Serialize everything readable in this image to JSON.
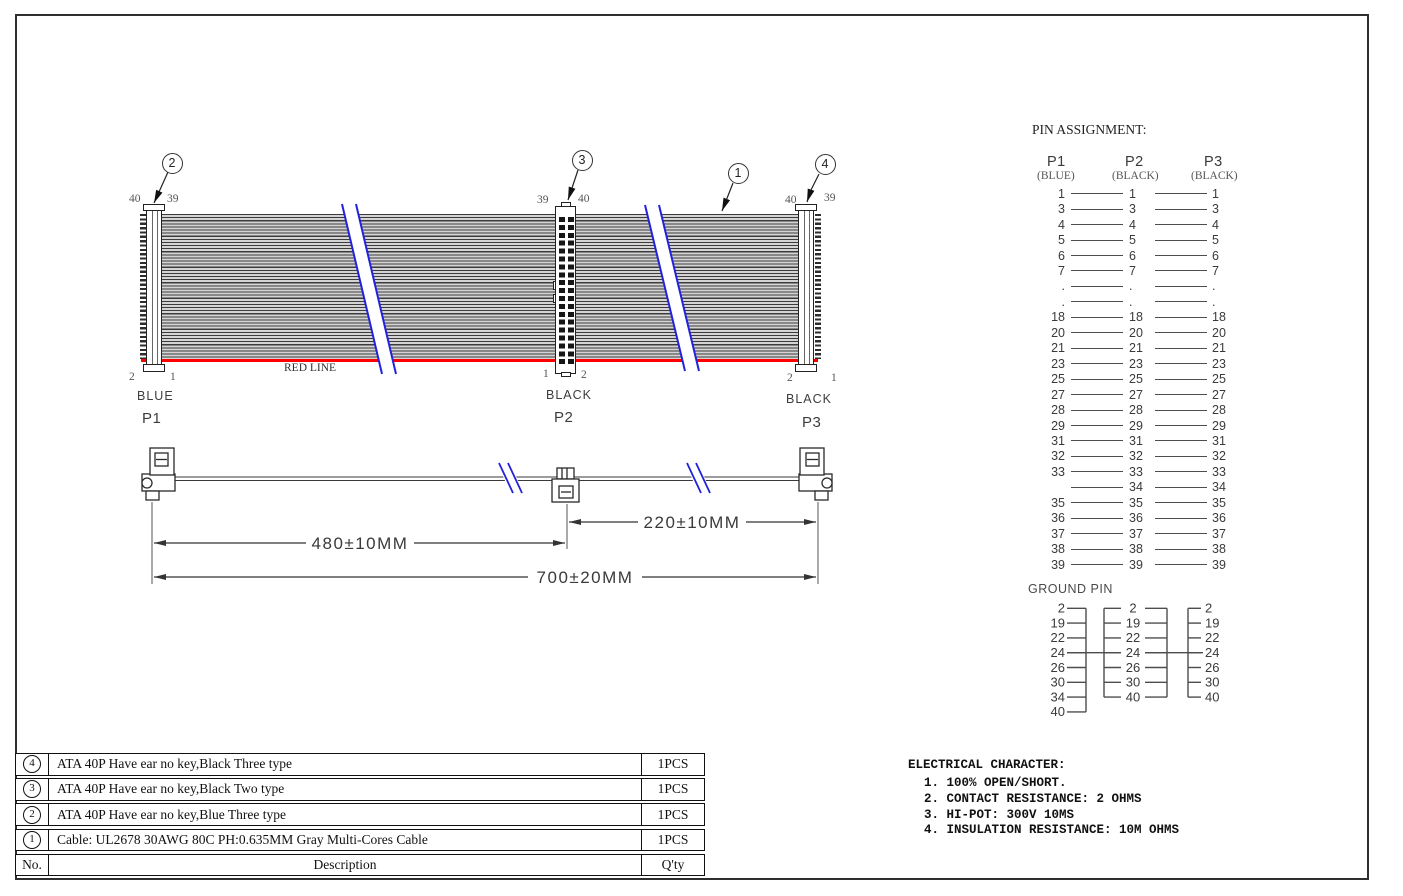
{
  "drawing": {
    "red_line_label": "RED LINE",
    "balloons": {
      "b1": "1",
      "b2": "2",
      "b3": "3",
      "b4": "4"
    },
    "connectors": [
      {
        "name": "P1",
        "color_label": "BLUE",
        "pins": {
          "tl": "40",
          "tr": "39",
          "bl": "2",
          "br": "1"
        }
      },
      {
        "name": "P2",
        "color_label": "BLACK",
        "pins": {
          "tl": "39",
          "tr": "40",
          "bl": "1",
          "br": "2"
        }
      },
      {
        "name": "P3",
        "color_label": "BLACK",
        "pins": {
          "tl": "40",
          "tr": "39",
          "bl": "2",
          "br": "1"
        }
      }
    ]
  },
  "dimensions": {
    "seg1": "480±10MM",
    "seg2": "220±10MM",
    "total": "700±20MM"
  },
  "pin_assignment": {
    "title": "PIN ASSIGNMENT:",
    "columns": [
      {
        "name": "P1",
        "color": "(BLUE)"
      },
      {
        "name": "P2",
        "color": "(BLACK)"
      },
      {
        "name": "P3",
        "color": "(BLACK)"
      }
    ],
    "rows": [
      [
        "1",
        "1",
        "1"
      ],
      [
        "3",
        "3",
        "3"
      ],
      [
        "4",
        "4",
        "4"
      ],
      [
        "5",
        "5",
        "5"
      ],
      [
        "6",
        "6",
        "6"
      ],
      [
        "7",
        "7",
        "7"
      ],
      [
        ".",
        ".",
        "."
      ],
      [
        ".",
        ".",
        "."
      ],
      [
        "18",
        "18",
        "18"
      ],
      [
        "20",
        "20",
        "20"
      ],
      [
        "21",
        "21",
        "21"
      ],
      [
        "23",
        "23",
        "23"
      ],
      [
        "25",
        "25",
        "25"
      ],
      [
        "27",
        "27",
        "27"
      ],
      [
        "28",
        "28",
        "28"
      ],
      [
        "29",
        "29",
        "29"
      ],
      [
        "31",
        "31",
        "31"
      ],
      [
        "32",
        "32",
        "32"
      ],
      [
        "33",
        "33",
        "33"
      ],
      [
        "",
        "34",
        "34"
      ],
      [
        "35",
        "35",
        "35"
      ],
      [
        "36",
        "36",
        "36"
      ],
      [
        "37",
        "37",
        "37"
      ],
      [
        "38",
        "38",
        "38"
      ],
      [
        "39",
        "39",
        "39"
      ]
    ],
    "ground_title": "GROUND PIN",
    "ground": {
      "p1": [
        "2",
        "19",
        "22",
        "24",
        "26",
        "30",
        "34",
        "40"
      ],
      "p2": [
        "2",
        "19",
        "22",
        "24",
        "26",
        "30",
        "40"
      ],
      "p3": [
        "2",
        "19",
        "22",
        "24",
        "26",
        "30",
        "40"
      ],
      "tie_pin": "24"
    }
  },
  "parts_table": {
    "header": {
      "no": "No.",
      "desc": "Description",
      "qty": "Q'ty"
    },
    "rows": [
      {
        "no": "4",
        "desc": "ATA 40P Have ear no key,Black Three type",
        "qty": "1PCS"
      },
      {
        "no": "3",
        "desc": "ATA 40P Have ear no key,Black Two type",
        "qty": "1PCS"
      },
      {
        "no": "2",
        "desc": "ATA 40P Have ear no key,Blue Three type",
        "qty": "1PCS"
      },
      {
        "no": "1",
        "desc": "Cable: UL2678 30AWG 80C PH:0.635MM Gray Multi-Cores Cable",
        "qty": "1PCS"
      }
    ]
  },
  "electrical": {
    "title": "ELECTRICAL CHARACTER:",
    "items": [
      "1. 100% OPEN/SHORT.",
      "2. CONTACT RESISTANCE: 2 OHMS",
      "3. HI-POT: 300V 10MS",
      "4. INSULATION RESISTANCE: 10M OHMS"
    ]
  },
  "colors": {
    "red_line": "#ff0000",
    "break_line": "#2222dd",
    "draw_line": "#333333"
  }
}
